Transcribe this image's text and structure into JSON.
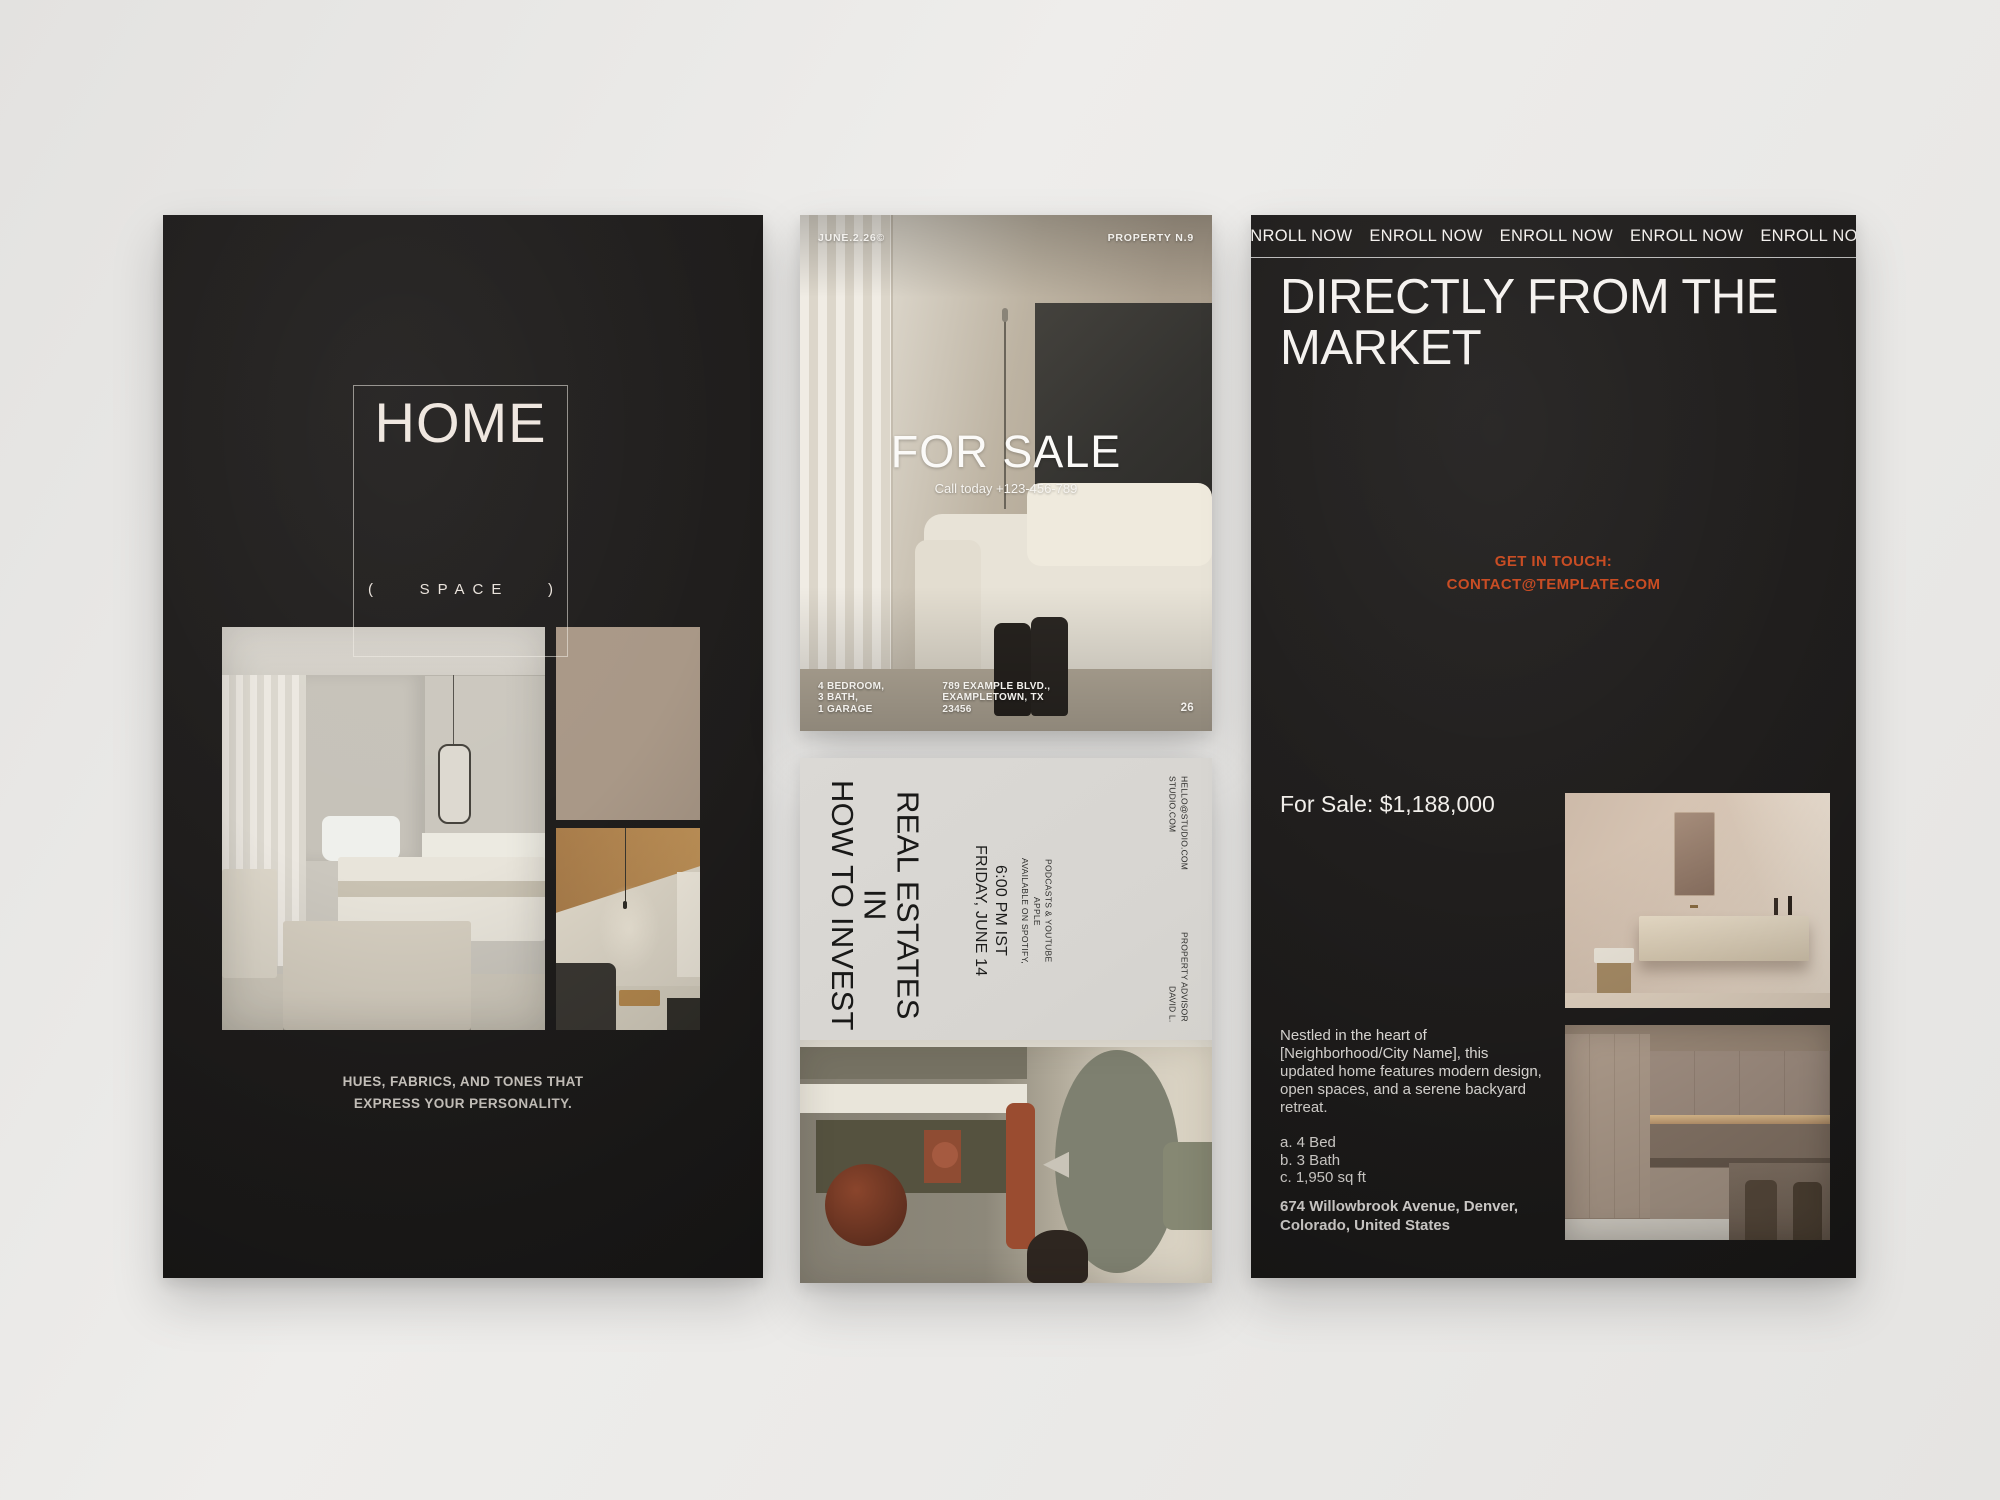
{
  "colors": {
    "page_bg": "#e9e8e6",
    "card_dark": "#201e1d",
    "card_light": "#d7d5d1",
    "beige_accent": "#a99887",
    "orange_accent": "#c8491f"
  },
  "home_card": {
    "title": "HOME",
    "paren_left": "(",
    "subtitle": "SPACE",
    "paren_right": ")",
    "caption_line1": "HUES, FABRICS, AND TONES THAT",
    "caption_line2": "EXPRESS YOUR PERSONALITY."
  },
  "for_sale_card": {
    "date": "JUNE.2.26©",
    "property_no": "PROPERTY N.9",
    "headline": "FOR SALE",
    "call_to_action": "Call today +123-456-789",
    "features": [
      "4 BEDROOM,",
      "3 BATH,",
      "1 GARAGE"
    ],
    "address_lines": [
      "789 EXAMPLE BLVD.,",
      "EXAMPLETOWN, TX",
      "23456"
    ],
    "page_number": "26"
  },
  "podcast_card": {
    "title_line1": "HOW TO INVEST IN",
    "title_line2": "REAL ESTATES",
    "date_line": "FRIDAY, JUNE 14",
    "time_line": "6:00 PM IST",
    "availability_line1": "AVAILABLE ON SPOTIFY, APPLE",
    "availability_line2": "PODCASTS & YOUTUBE",
    "website": "STUDIO.COM",
    "email": "HELLO@STUDIO.COM",
    "host_name": "DAVID L.",
    "host_role": "PROPERTY ADVISOR"
  },
  "market_card": {
    "marquee": "ENROLL NOW",
    "title_line1": "DIRECTLY FROM THE",
    "title_line2": "MARKET",
    "contact_label": "GET IN TOUCH:",
    "contact_email": "CONTACT@TEMPLATE.COM",
    "price": "For Sale: $1,188,000",
    "description": "Nestled in the heart of [Neighborhood/City Name], this updated home features modern design, open spaces, and a serene backyard retreat.",
    "spec_a": "a. 4 Bed",
    "spec_b": "b. 3 Bath",
    "spec_c": "c. 1,950 sq ft",
    "address_line1": "674 Willowbrook Avenue, Denver,",
    "address_line2": "Colorado, United States"
  }
}
